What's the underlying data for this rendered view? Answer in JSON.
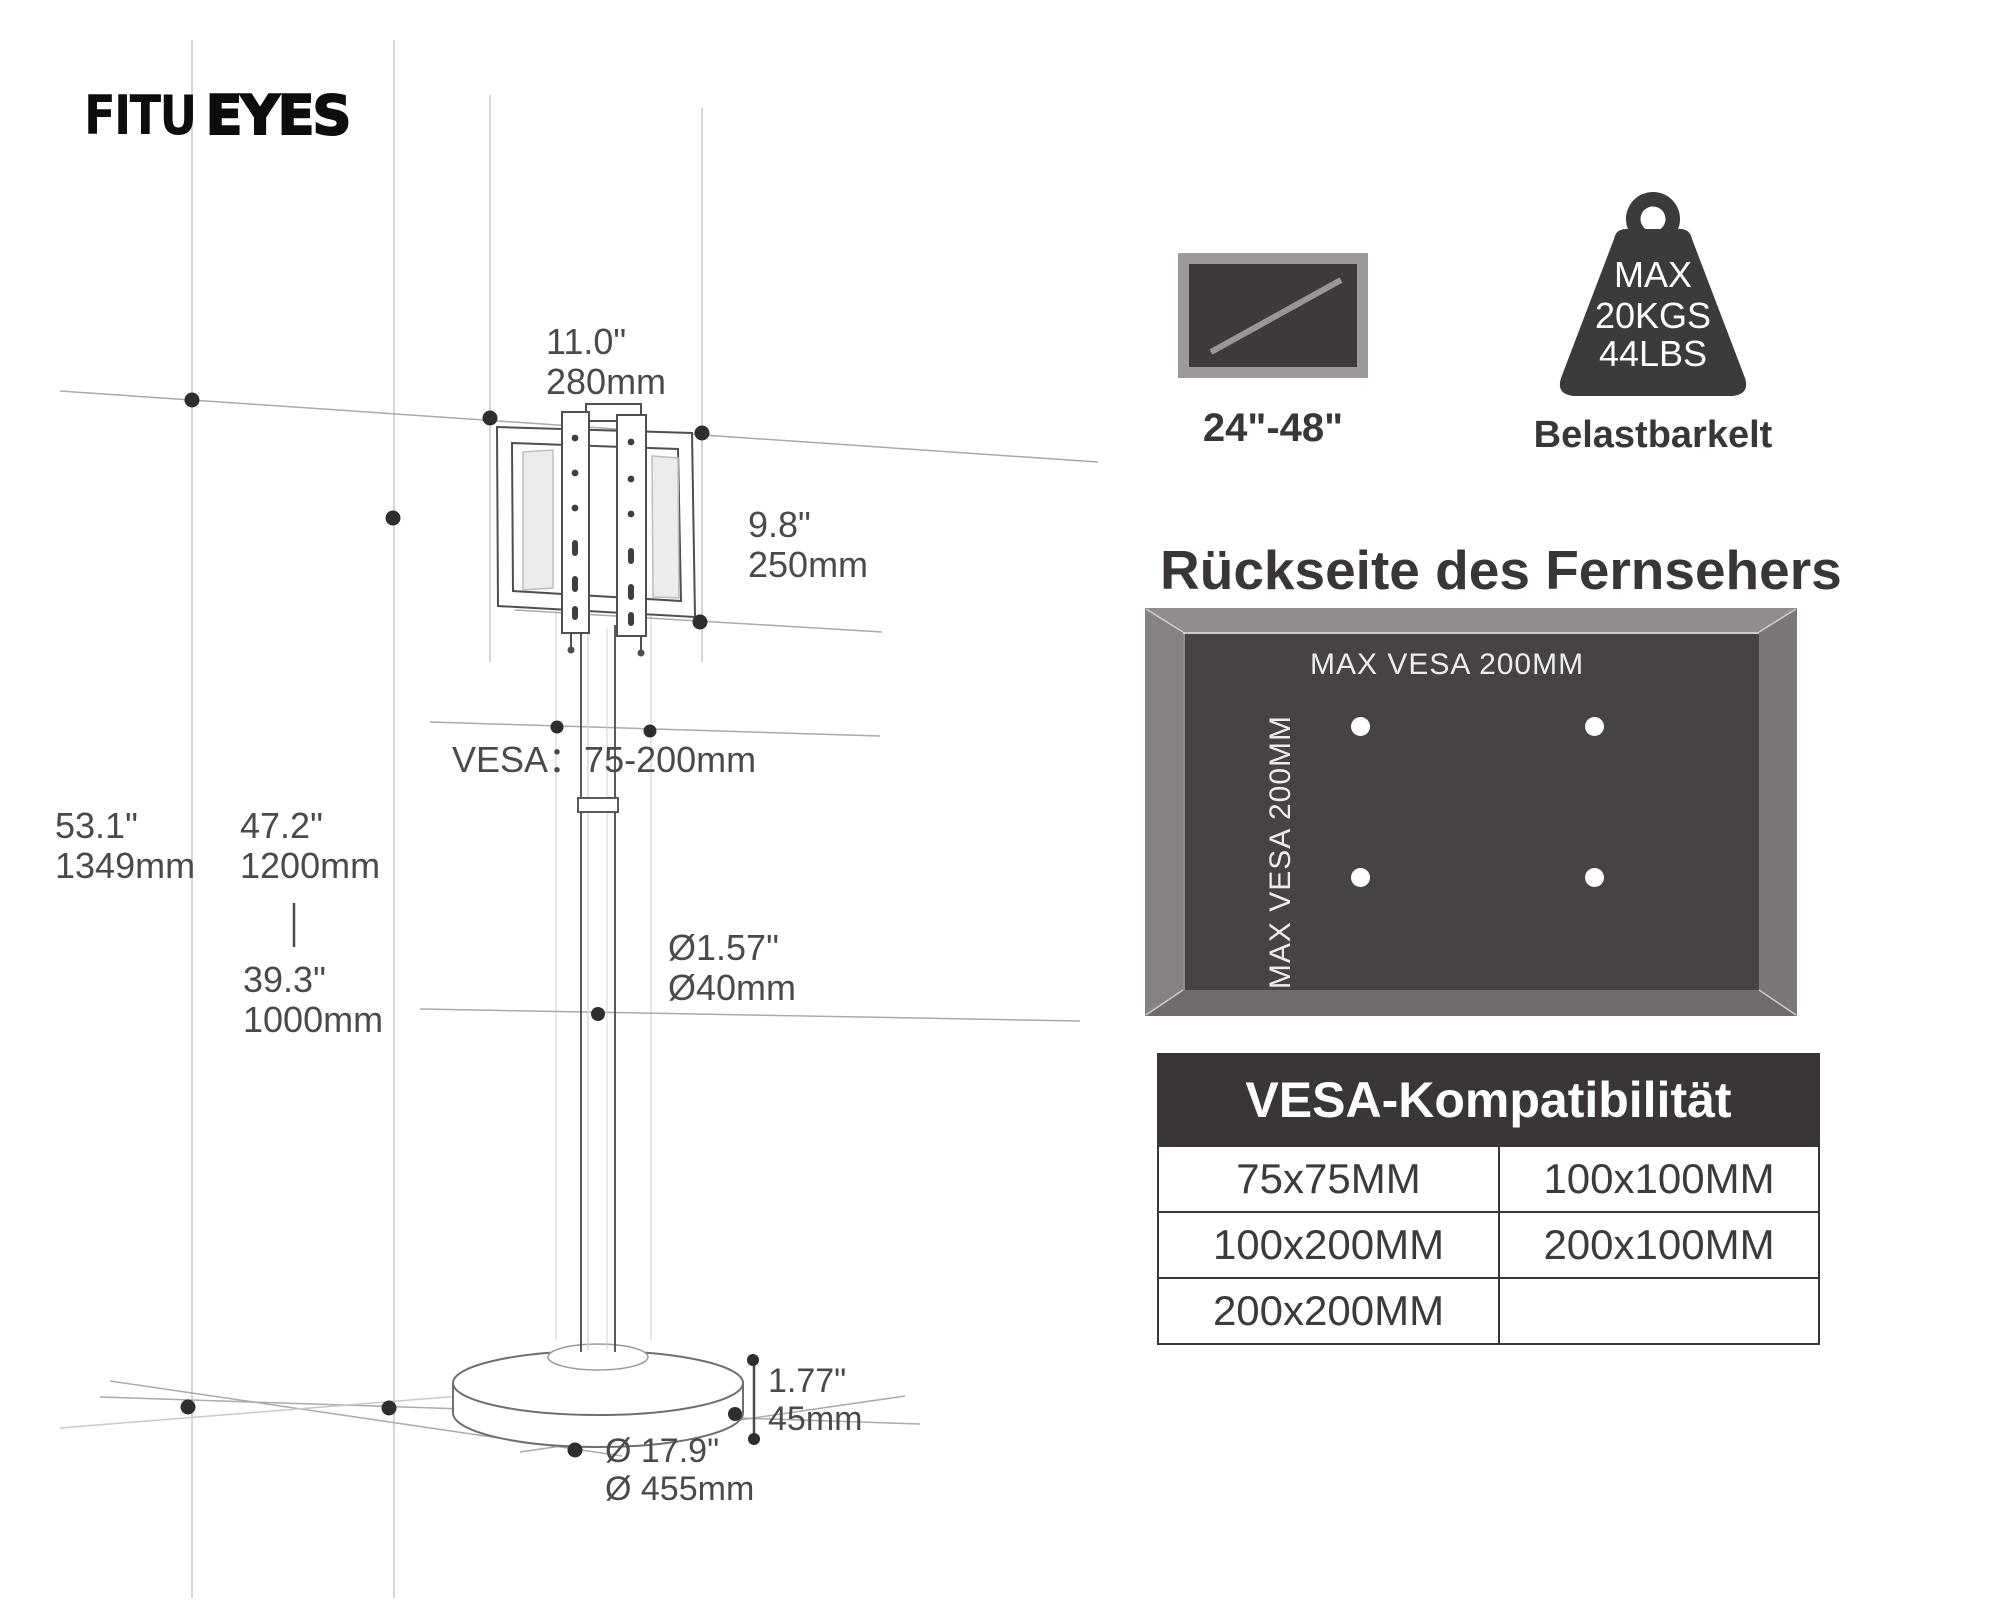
{
  "brand": {
    "name_light": "FITU",
    "name_bold": "EYES"
  },
  "dimensions": {
    "bracket_width_in": "11.0\"",
    "bracket_width_mm": "280mm",
    "bracket_height_in": "9.8\"",
    "bracket_height_mm": "250mm",
    "vesa_range": "VESA：75-200mm",
    "total_height_in": "53.1\"",
    "total_height_mm": "1349mm",
    "pole_height_max_in": "47.2\"",
    "pole_height_max_mm": "1200mm",
    "pole_height_min_in": "39.3\"",
    "pole_height_min_mm": "1000mm",
    "pole_diameter_in": "Ø1.57\"",
    "pole_diameter_mm": "Ø40mm",
    "base_thickness_in": "1.77\"",
    "base_thickness_mm": "45mm",
    "base_diameter_in": "Ø 17.9\"",
    "base_diameter_mm": "Ø 455mm"
  },
  "screen_size": {
    "range": "24\"-48\""
  },
  "capacity": {
    "line1": "MAX",
    "line2": "20KGS",
    "line3": "44LBS",
    "caption": "Belastbarkelt"
  },
  "back_panel": {
    "heading": "Rückseite des Fernsehers",
    "vesa_horizontal": "MAX VESA 200MM",
    "vesa_vertical": "MAX VESA 200MM"
  },
  "vesa_table": {
    "title": "VESA-Kompatibilität",
    "rows": [
      [
        "75x75MM",
        "100x100MM"
      ],
      [
        "100x200MM",
        "200x100MM"
      ],
      [
        "200x200MM",
        ""
      ]
    ]
  },
  "colors": {
    "dark": "#3a3637",
    "panel_frame": "#8a8686",
    "panel_inner": "#474243",
    "sketch_line": "#a8a8a8"
  }
}
